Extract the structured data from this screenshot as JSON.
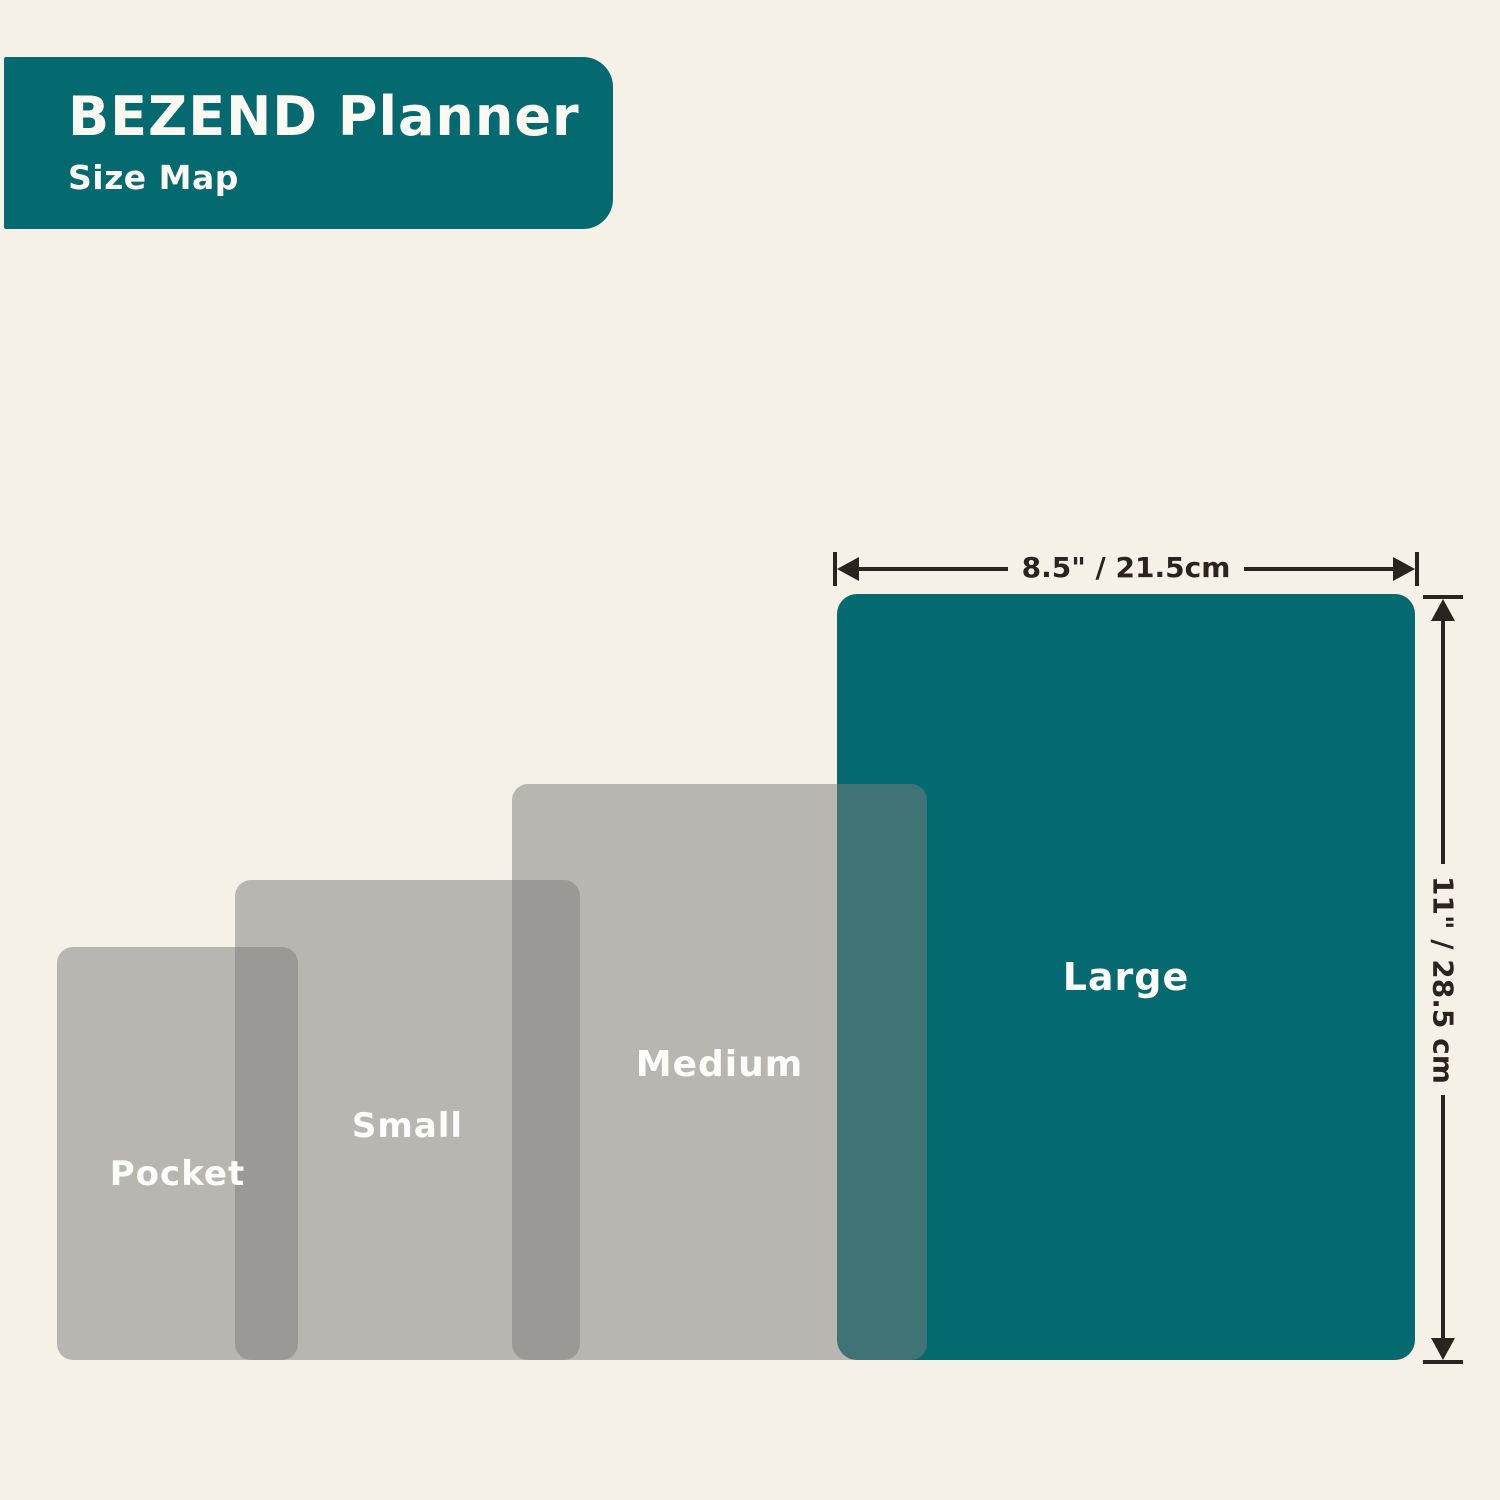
{
  "title_badge": {
    "title": "BEZEND Planner",
    "subtitle": "Size Map"
  },
  "sizes": [
    {
      "label": "Pocket"
    },
    {
      "label": "Small"
    },
    {
      "label": "Medium"
    },
    {
      "label": "Large"
    }
  ],
  "large_dimensions": {
    "width": "8.5\" / 21.5cm",
    "height": "11\" / 28.5 cm"
  },
  "colors": {
    "background": "#f5f1e7",
    "teal": "#056a70",
    "overlay_gray": "rgba(124,124,124,0.5)",
    "dimension_ink": "#2a241f",
    "text_on_teal": "#fbf9f1"
  }
}
